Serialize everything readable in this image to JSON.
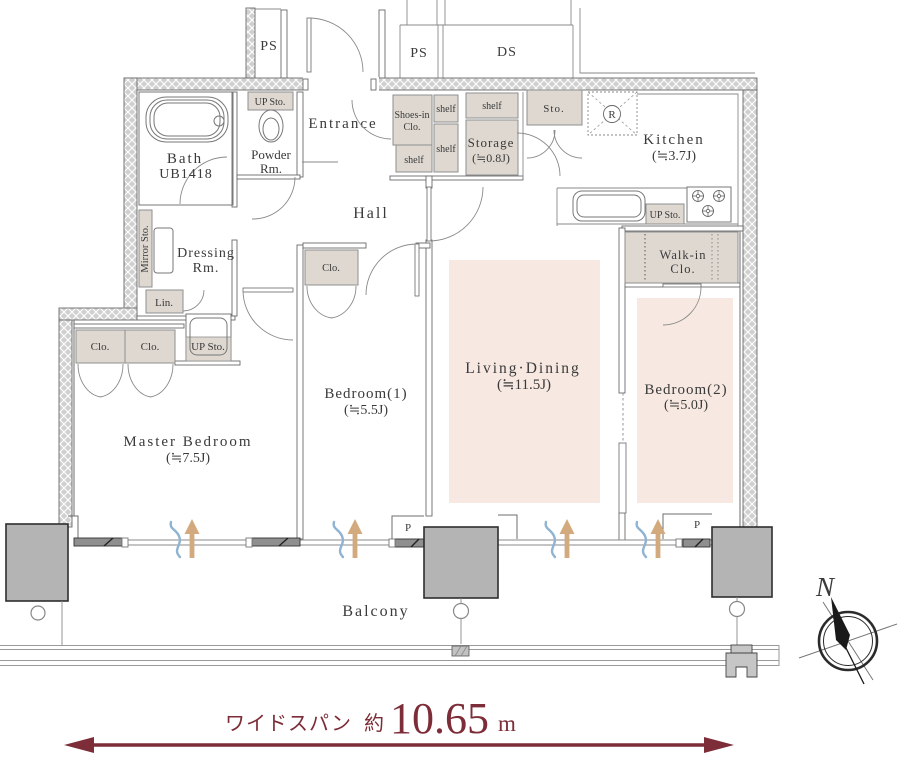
{
  "colors": {
    "wall": "#d0d0d0",
    "closet_beige": "#ded8d0",
    "room_pink": "#f7e9e1",
    "line_gray": "#6e6e6e",
    "pillar_gray": "#b4b4b4",
    "dimension_maroon": "#7c2d37",
    "airflow_blue": "#8fb3d2",
    "airflow_tan": "#d3aa7e",
    "text": "#3a3a3a"
  },
  "shafts": {
    "ps_left": "PS",
    "ps_right": "PS",
    "ds": "DS"
  },
  "rooms": {
    "bath": {
      "name": "Bath",
      "code": "UB1418"
    },
    "powder": {
      "line1": "Powder",
      "line2": "Rm."
    },
    "entrance": {
      "name": "Entrance"
    },
    "hall": {
      "name": "Hall"
    },
    "kitchen": {
      "name": "Kitchen",
      "size": "(≒3.7J)"
    },
    "storage": {
      "name": "Storage",
      "size": "(≒0.8J)"
    },
    "living": {
      "name": "Living·Dining",
      "size": "(≒11.5J)"
    },
    "bedroom1": {
      "name": "Bedroom(1)",
      "size": "(≒5.5J)"
    },
    "bedroom2": {
      "name": "Bedroom(2)",
      "size": "(≒5.0J)"
    },
    "master": {
      "name": "Master Bedroom",
      "size": "(≒7.5J)"
    },
    "dressing": {
      "line1": "Dressing",
      "line2": "Rm."
    },
    "walkin": {
      "line1": "Walk-in",
      "line2": "Clo."
    },
    "balcony": {
      "name": "Balcony"
    }
  },
  "closets": {
    "shoes_line1": "Shoes-in",
    "shoes_line2": "Clo.",
    "shelf_a": "shelf",
    "shelf_b": "shelf",
    "shelf_c": "shelf",
    "shelf_d": "shelf",
    "sto": "Sto.",
    "lin": "Lin.",
    "mirror": "Mirror Sto.",
    "clo_master_1": "Clo.",
    "clo_master_2": "Clo.",
    "clo_bedroom1": "Clo.",
    "up_sto_powder": "UP Sto.",
    "up_sto_kitchen": "UP Sto.",
    "up_sto_corridor": "UP Sto."
  },
  "markers": {
    "refrigerator": "R",
    "pillar_left": "P",
    "pillar_right": "P",
    "compass_north": "N"
  },
  "dimension": {
    "label": "ワイドスパン",
    "approx": "約",
    "value": "10.65",
    "unit": "m"
  }
}
